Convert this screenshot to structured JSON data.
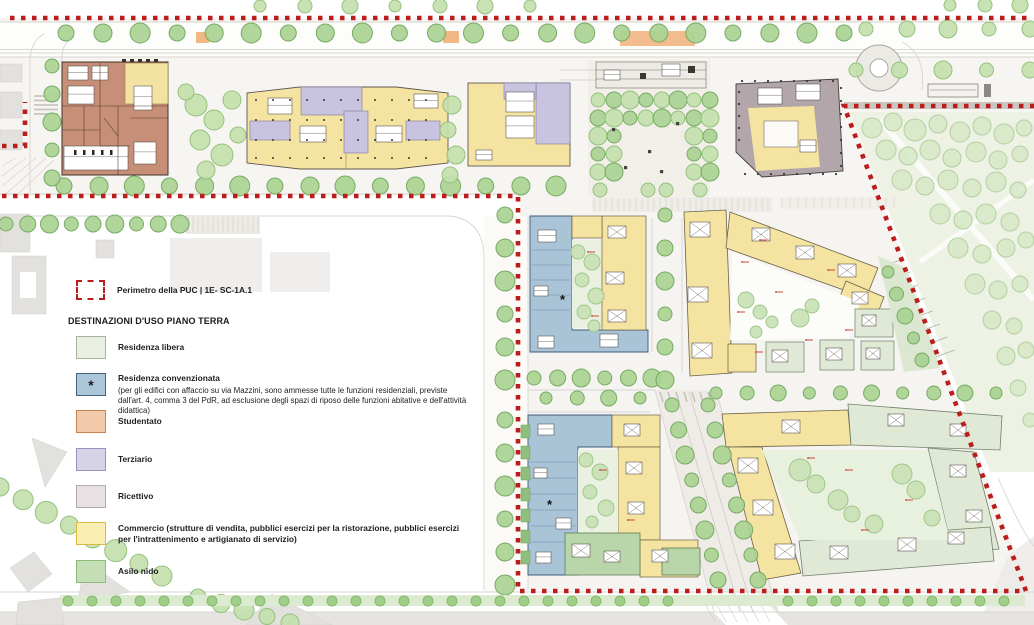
{
  "map": {
    "marker": "*"
  },
  "colors": {
    "perimeter": "#bb1d1c",
    "commercio": "#f5e3a1",
    "terziario": "#c8c3de",
    "ricettivo": "#b2a6aa",
    "studentato": "#c78e78",
    "convenzionata": "#a9c3d7",
    "residenza_libera": "#e0e9d6",
    "asilo_nido": "#b9d6aa"
  },
  "legend": {
    "perimeter_label": "Perimetro della PUC | 1E- SC-1A.1",
    "title": "DESTINAZIONI D'USO PIANO TERRA",
    "items": [
      {
        "key": "residenza-libera",
        "label": "Residenza libera",
        "color": "#e9efe2",
        "border": "#a9b49e"
      },
      {
        "key": "residenza-convenzionata",
        "label": "Residenza convenzionata",
        "symbol": "*",
        "note": "(per gli edifici con affaccio su via Mazzini, sono ammesse tutte le funzioni residenziali, previste dall'art. 4, comma 3 del PdR, ad esclusione degli spazi di riposo delle funzioni abitative e dell'attività didattica)",
        "color": "#abc5d9",
        "border": "#44637d"
      },
      {
        "key": "studentato",
        "label": "Studentato",
        "color": "#f2c9a9",
        "border": "#c8824d"
      },
      {
        "key": "terziario",
        "label": "Terziario",
        "color": "#d7d3e7",
        "border": "#9b90bf"
      },
      {
        "key": "ricettivo",
        "label": "Ricettivo",
        "color": "#e7e1e4",
        "border": "#b3a9af"
      },
      {
        "key": "commercio",
        "label": "Commercio (strutture di vendita, pubblici esercizi per la ristorazione, pubblici esercizi per l'intrattenimento e artigianato di servizio)",
        "color": "#fbeeb3",
        "border": "#dcba3f"
      },
      {
        "key": "asilo-nido",
        "label": "Asilo nido",
        "color": "#c4deb5",
        "border": "#8fba7c"
      }
    ]
  }
}
